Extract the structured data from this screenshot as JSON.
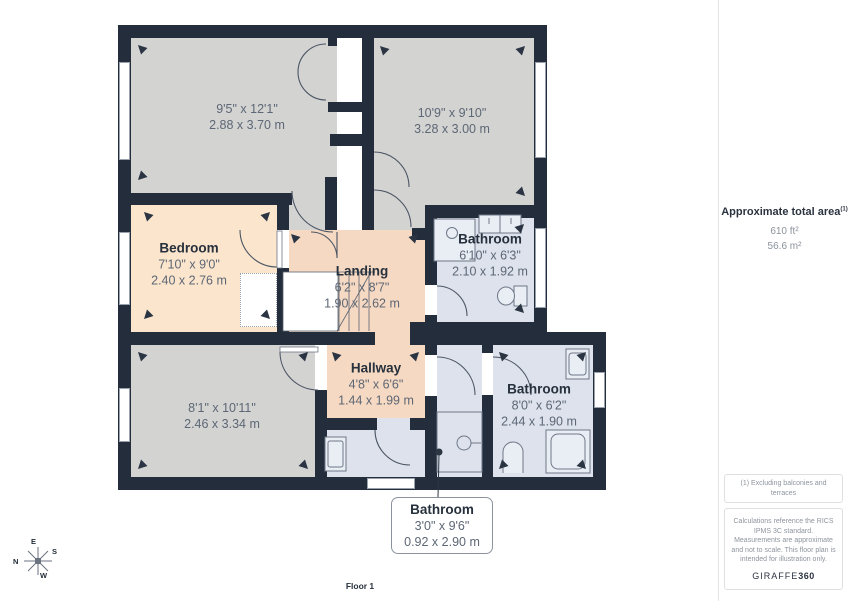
{
  "floorplan": {
    "floor_label": "Floor 1",
    "rooms": [
      {
        "name": "",
        "dim_ft": "9'5\" x 12'1\"",
        "dim_m": "2.88 x 3.70 m"
      },
      {
        "name": "",
        "dim_ft": "10'9\" x 9'10\"",
        "dim_m": "3.28 x 3.00 m"
      },
      {
        "name": "Bedroom",
        "dim_ft": "7'10\" x 9'0\"",
        "dim_m": "2.40 x 2.76 m"
      },
      {
        "name": "Landing",
        "dim_ft": "6'2\" x 8'7\"",
        "dim_m": "1.90 x 2.62 m"
      },
      {
        "name": "Bathroom",
        "dim_ft": "6'10\" x 6'3\"",
        "dim_m": "2.10 x 1.92 m"
      },
      {
        "name": "",
        "dim_ft": "8'1\" x 10'11\"",
        "dim_m": "2.46 x 3.34 m"
      },
      {
        "name": "Hallway",
        "dim_ft": "4'8\" x 6'6\"",
        "dim_m": "1.44 x 1.99 m"
      },
      {
        "name": "Bathroom",
        "dim_ft": "8'0\" x 6'2\"",
        "dim_m": "2.44 x 1.90 m"
      },
      {
        "name": "Bathroom",
        "dim_ft": "3'0\" x 9'6\"",
        "dim_m": "0.92 x 2.90 m"
      }
    ],
    "compass": {
      "n": "N",
      "e": "E",
      "s": "S",
      "w": "W"
    }
  },
  "sidebar": {
    "total_area_label": "Approximate total area",
    "total_area_note_ref": "(1)",
    "area_ft": "610 ft²",
    "area_m": "56.6 m²",
    "footnote": "(1) Excluding balconies and terraces",
    "disclaimer": "Calculations reference the RICS IPMS 3C standard. Measurements are approximate and not to scale. This floor plan is intended for illustration only.",
    "brand_name": "GIRAFFE",
    "brand_suffix": "360"
  },
  "colors": {
    "wall": "#232d3b",
    "room_gray": "#d3d3d2",
    "room_peach": "#fbe5cd",
    "room_peach_dark": "#f6d9c2",
    "room_blue": "#dde2ed",
    "name_text": "#27313d",
    "dim_text": "#5d6775"
  }
}
